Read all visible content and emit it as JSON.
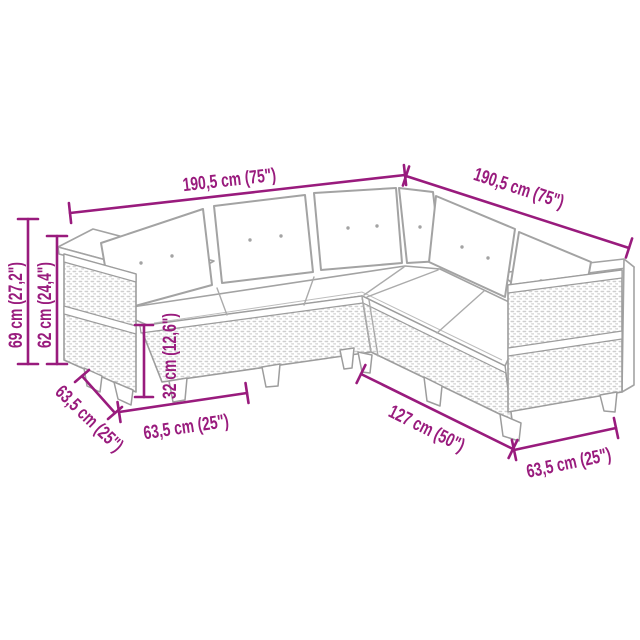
{
  "page": {
    "background_color": "#ffffff",
    "accent_color": "#991b7d",
    "sketch_color": "#a3a3a3"
  },
  "diagram": {
    "subject": "5-piece L-shaped rattan garden sofa set, outline product drawing with dimensions",
    "labels": {
      "top_left_length": "190,5 cm (75\")",
      "top_right_length": "190,5 cm (75\")",
      "overall_height": "69 cm (27,2\")",
      "back_height": "62 cm (24,4\")",
      "seat_height": "32 cm (12,6\")",
      "left_end_depth": "63,5 cm (25\")",
      "left_front_width": "63,5 cm (25\")",
      "right_front_width": "127 cm (50\")",
      "right_end_depth": "63,5 cm (25\")"
    }
  }
}
